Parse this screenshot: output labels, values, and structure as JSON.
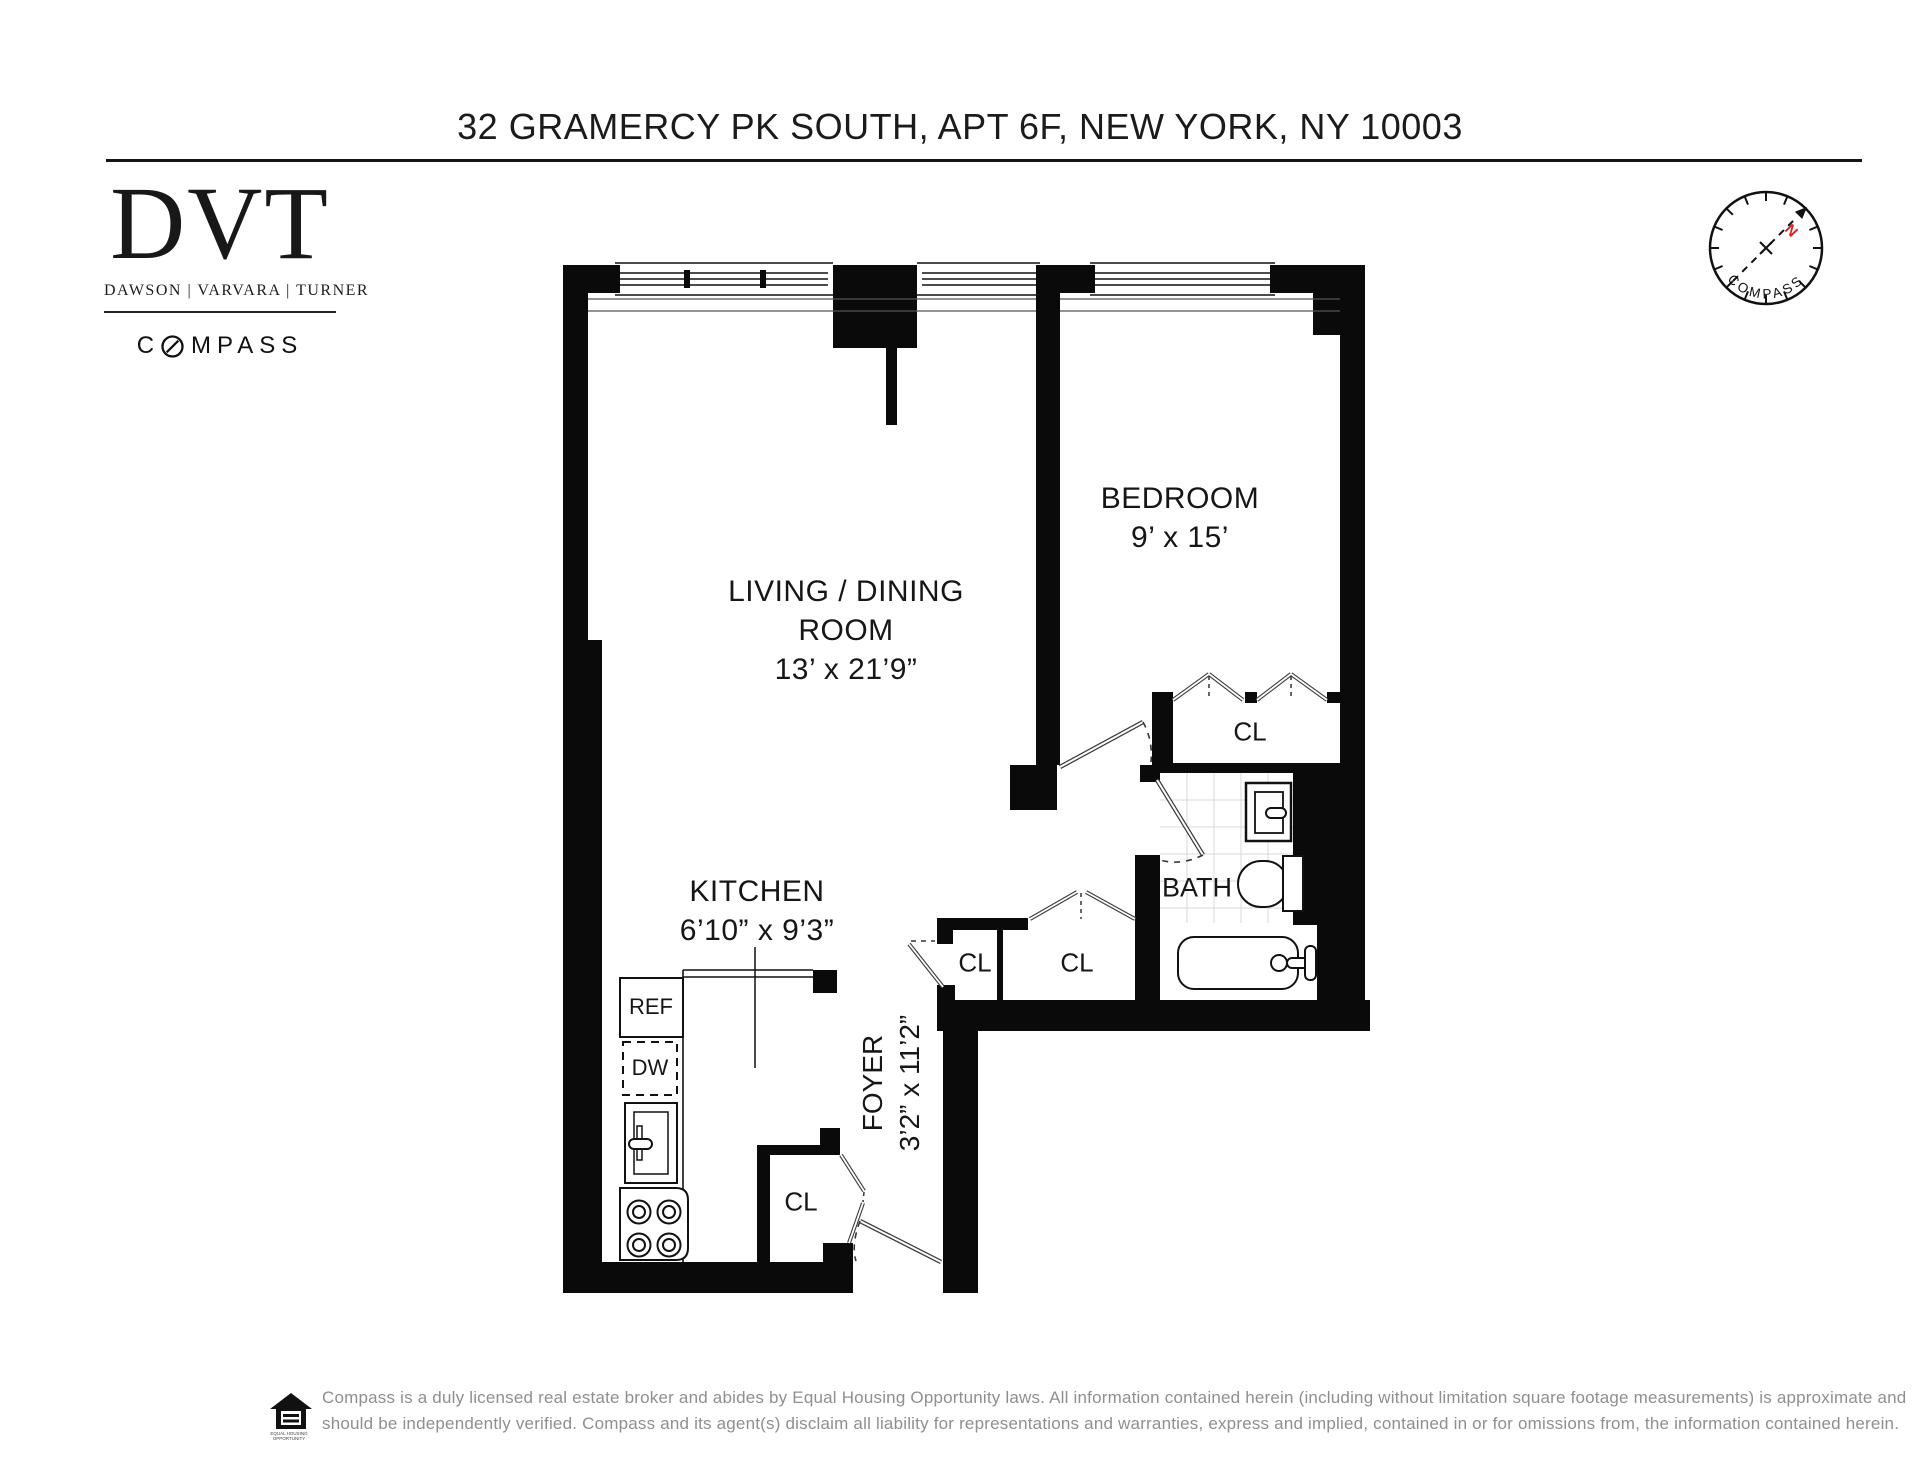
{
  "header": {
    "title": "32 GRAMERCY PK SOUTH, APT 6F, NEW YORK, NY 10003"
  },
  "brokerage": {
    "initials": "DVT",
    "agent_names": "DAWSON | VARVARA | TURNER",
    "brand_start": "C",
    "brand_end": "MPASS"
  },
  "compass_rose": {
    "brand": "COMPASS",
    "north": "N",
    "north_color": "#d9251d"
  },
  "plan": {
    "rooms": {
      "living": {
        "line1": "LIVING / DINING",
        "line2": "ROOM",
        "dims": "13’ x 21’9”"
      },
      "bedroom": {
        "name": "BEDROOM",
        "dims": "9’ x 15’"
      },
      "kitchen": {
        "name": "KITCHEN",
        "dims": "6’10” x 9’3”"
      },
      "foyer": {
        "name": "FOYER",
        "dims": "3’2” x 11’2”"
      },
      "bath": {
        "name": "BATH"
      }
    },
    "closets": {
      "bedroom_closet": "CL",
      "hall_closet_left": "CL",
      "hall_closet_right": "CL",
      "kitchen_closet": "CL"
    },
    "appliances": {
      "refrigerator": "REF",
      "dishwasher": "DW"
    }
  },
  "footer": {
    "line1": "Compass is a duly licensed real estate broker and abides by Equal Housing Opportunity laws. All information contained herein (including without limitation square footage measurements) is approximate and",
    "line2": "should be independently verified. Compass and its agent(s) disclaim all liability for representations and warranties, express and implied, contained in or for omissions from, the information contained herein.",
    "equal_housing_label": "EQUAL HOUSING OPPORTUNITY"
  }
}
